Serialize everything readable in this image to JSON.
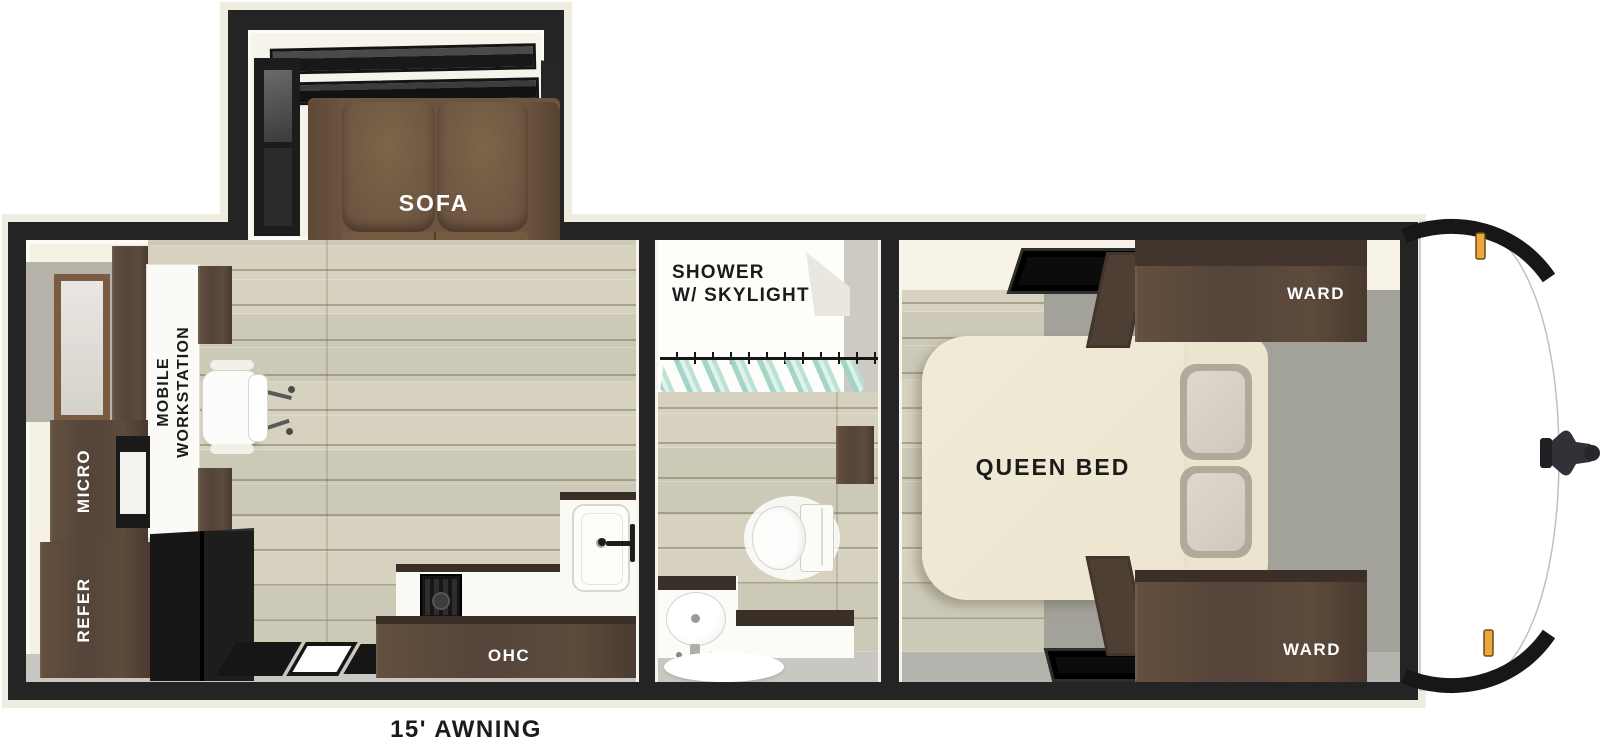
{
  "floorplan": {
    "slideout": {
      "sofa_label": "SOFA"
    },
    "galley": {
      "workstation_label": "MOBILE WORKSTATION",
      "micro_label": "MICRO",
      "refer_label": "REFER",
      "ohc_label": "OHC"
    },
    "bath": {
      "shower_label": "SHOWER\nW/ SKYLIGHT"
    },
    "bedroom": {
      "bed_label": "QUEEN BED",
      "ward_top_label": "WARD",
      "ward_bottom_label": "WARD"
    },
    "exterior": {
      "awning_label": "15' AWNING"
    }
  },
  "colors": {
    "wall": "#242424",
    "wood_floor": "#d6d2bf",
    "bedroom_gray_floor": "#a3a29a",
    "walkway_gray": "#c8c7c1",
    "cabinet_brown": "#5a4939",
    "sofa_brown": "#6b5440",
    "bed_cream": "#efe9d4",
    "curtain_teal": "#c2e3d9",
    "clearance_light_amber": "#eda73f",
    "front_cap_white": "#ffffff"
  }
}
